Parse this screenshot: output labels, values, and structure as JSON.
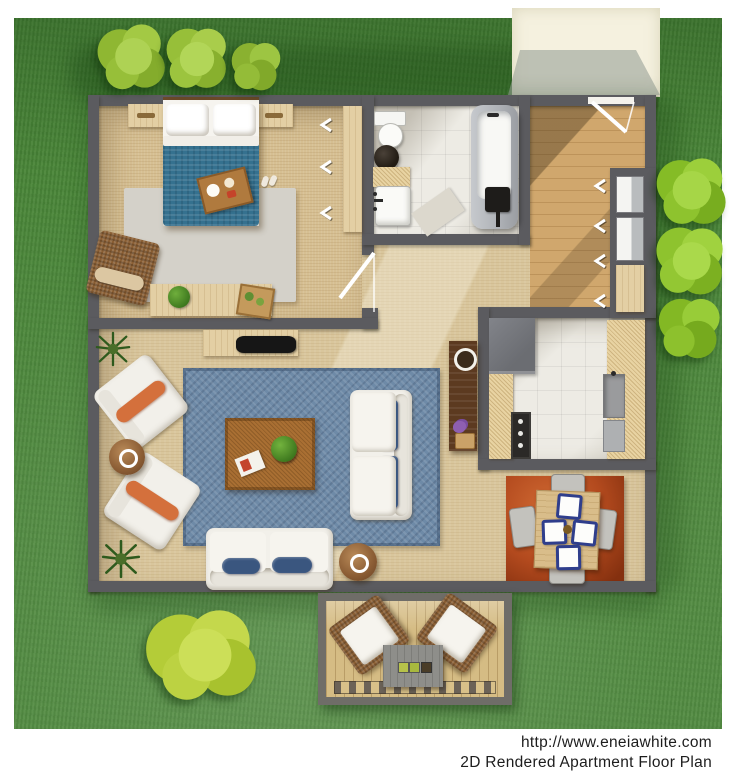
{
  "caption": {
    "url": "http://www.eneiawhite.com",
    "title": "2D Rendered Apartment Floor Plan"
  },
  "palette": {
    "grass": "#4b873a",
    "grass_dark": "#3d7330",
    "wall": "#5b5b5f",
    "floor_tan": "#d9c69c",
    "bedroom_carpet": "#d6bf92",
    "tile": "#edebe4",
    "entry_wood": "#d0a76d",
    "rug_blue": "#6e8aa7",
    "rug_gray": "#d4d1c9",
    "rug_rust": "#b34a1e",
    "duvet_blue": "#35718f",
    "sofa_white": "#f2f0ea",
    "cushion_navy": "#3a567f",
    "accent_orange": "#d4703c",
    "table_brown": "#a96f33",
    "wood_dark": "#5c3a20",
    "counter": "#e8d3a2",
    "deck_wood": "#d5bc84",
    "walkway": "#f5f1df",
    "bush_top": "#9cc344",
    "bush_right": "#8fc32f",
    "bush_bottom": "#b8cf3f"
  }
}
